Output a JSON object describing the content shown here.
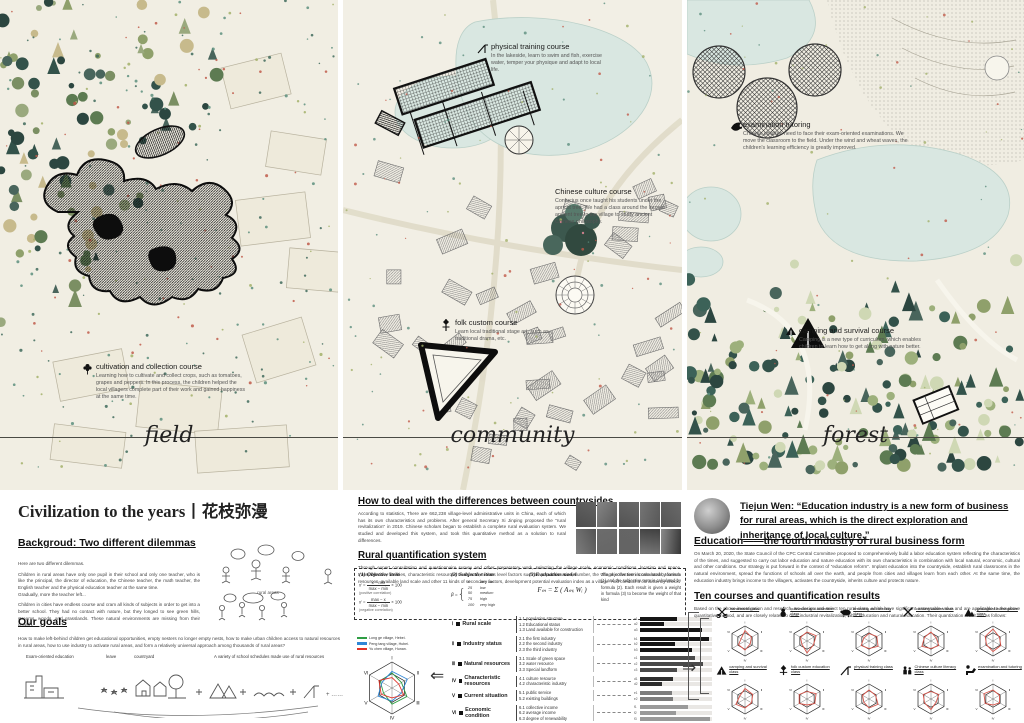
{
  "accent_colors": {
    "water": "#d9e7e1",
    "paper": "#f1eee3",
    "black": "#111111",
    "red_speckle": "#c05a4a"
  },
  "panels": {
    "field": {
      "label": "field",
      "annotation": {
        "icon": "flower-icon",
        "title": "cultivation and collection course",
        "body": "Learning how to cultivate and collect crops, such as tomatoes, grapes and peppers. In this process, the children helped the local villagers complete part of their work and gained happiness at the same time."
      }
    },
    "community": {
      "label": "community",
      "annotations": [
        {
          "icon": "slide-icon",
          "title": "physical training course",
          "body": "In the lakeside, learn to swim and fish, exercise water, temper your physique and adapt to local life."
        },
        {
          "icon": "tree-icon",
          "title": "Chinese culture course",
          "body": "Confucius once taught his students under the apricot tree. We had a class around the largest ancient tree in the village to study ancient Chinese philosophy."
        },
        {
          "icon": "totem-icon",
          "title": "folk custom course",
          "body": "Learn local traditional stage art, such as traditional drama, etc."
        }
      ]
    },
    "forest": {
      "label": "forest",
      "annotations": [
        {
          "icon": "bird-icon",
          "title": "examination tutoring",
          "body": "Chinese children need to face their exam-oriented examinations. We move the classroom to the field. Under the wind and wheat waves, the children's learning efficiency is greatly improved."
        },
        {
          "icon": "tent-icon",
          "title": "camping and survival course",
          "body": "Camping is a new type of curriculum, which enables children to learn how to get along with nature better."
        }
      ]
    }
  },
  "left": {
    "title": "Civilization to the years丨花枝弥漫",
    "background_heading": "Backgroud: Two different dilemmas",
    "p1": "Here are two different dilemmas.",
    "p2": "Children in rural areas have only one pupil in their school and only one teacher, who is like the principal, the director of education, the Chinese teacher, the math teacher, the English teacher and the physical education teacher at the same time.",
    "p3": "Gradually, more the teacher left...",
    "p4": "Children in cities have endless course and cram all kinds of subjects in order to get into a better school. They had no contact with nature, but they longed to see green hills, streams, woods, and grasslands. These natural environments are missing from their growth.",
    "sketch_caption_rural": "rural areas",
    "goals_heading": "Our goals",
    "goals_text": "How to make left-behind children get educational opportunities, empty nesters no longer empty nests, how to make urban children access to natural resources in rural areas, how to use industry to activate rural areas, and form a relatively universal approach among thousands of rural areas?",
    "goal_captions": [
      "Exam-oriented education",
      "leave",
      "countryard",
      "A variety of school schedules made use of rural resources"
    ],
    "goal_more": "……"
  },
  "middle": {
    "h1": "How to deal with the differences between countrysides",
    "p1": "According to statistics, There are 662,238 village-level administrative units in China, each of which has its own characteristics and problems. After general Secretary Xi Jinping proposed the \"rural revitalization\" in 2019. Chinese scholars began to establish a complete rural evaluation system. We studied and developed this system, and took this quantitative method as a solution to rural differences.",
    "h2": "Rural quantification system",
    "p2": "Through expert consultation and questionnaire survey and other preparatory work, selecting the village scale, economic conditions, location and space transportation, facilities, characteristic resources to expand, 6-class level factors such as population size, number, the village collective income scale, tourism resources, available land scale and other 11 kinds of secondary factors, development potential evaluation index as a village. And conduct a consistency check.",
    "formulas": {
      "obj_label": "(1) Objective item",
      "obj_f1_num": "x − min",
      "obj_f1_den": "max − min",
      "obj_f1_note": "(positive correlation)",
      "obj_f2_num": "max − x",
      "obj_f2_den": "max − min",
      "obj_f2_note": "(negative correlation)",
      "times100": "× 100",
      "subj_label": "(2) Subjective item",
      "subj_var": "β =",
      "subj_scale": [
        [
          "0",
          "very low"
        ],
        [
          "25",
          "low"
        ],
        [
          "50",
          "medium"
        ],
        [
          "75",
          "high"
        ],
        [
          "100",
          "very high"
        ]
      ],
      "model_label": "(3)Evaluation model",
      "model_formula": "Fₘ = Σ ( Aₘᵢ Wᵢ )",
      "note": "The objective term is calculated by formula (1) and the subjective term is calculated by formula (2). Each result is given a weight in formula (3) to become the weight of that kind"
    },
    "legend": [
      {
        "color": "#2f9e44",
        "label": "Long ge village, Hebei."
      },
      {
        "color": "#2f86d6",
        "label": "Peng tang village, Hubei."
      },
      {
        "color": "#e03127",
        "label": "Yu chen village, Hunan."
      }
    ],
    "categories": [
      {
        "numeral": "Ⅰ",
        "label": "Rural scale"
      },
      {
        "numeral": "Ⅱ",
        "label": "Industry status"
      },
      {
        "numeral": "Ⅲ",
        "label": "Natural resources"
      },
      {
        "numeral": "Ⅳ",
        "label": "Characteristic resources"
      },
      {
        "numeral": "Ⅴ",
        "label": "Current situation"
      },
      {
        "numeral": "Ⅵ",
        "label": "Economic condition"
      }
    ]
  },
  "right": {
    "quote": "Tiejun Wen: “Education industry is a new form of business for rural areas, which is the direct exploration and inheritance of local culture.”",
    "h1": "Education——the fourth industry of rural business form",
    "p1": "On March 20, 2020, the State Council of the CPC Central Committee proposed to comprehensively build a labor education system reflecting the characteristics of the times, and suggested to carry out labor education and nature education with its own characteristics in combination with local natural, economic, cultural and other conditions. Our strategy is put forward in the context of \"education reform\". Implant education into the countryside, establish rural classrooms in the natural environment, spread the functions of schools all over the earth, and people from cities and villages learn from each other. At the same time, the education industry brings income to the villagers, activates the countryside, inherits culture and protects nature.",
    "h2": "Ten courses and quantification results",
    "p2": "Based on the above investigation and research, we design and select ten rural class, which have significant assessable value and are applicable to the above quantitative method, and are closely related to rural industrial revitalization, labor education and natural education. Their quantization result are as follows:",
    "courses": [
      {
        "icon": "scissors-icon",
        "label": "handmade class",
        "radar": [
          0.7,
          0.5,
          0.4,
          0.6,
          0.5,
          0.3
        ]
      },
      {
        "icon": "gourd-icon",
        "label": "cultivation and collection class",
        "radar": [
          0.6,
          0.7,
          0.5,
          0.8,
          0.4,
          0.5
        ]
      },
      {
        "icon": "pig-icon",
        "label": "breeding and feeding class",
        "radar": [
          0.5,
          0.6,
          0.7,
          0.5,
          0.6,
          0.4
        ]
      },
      {
        "icon": "chopsticks-icon",
        "label": "cooking cuisine class",
        "radar": [
          0.6,
          0.4,
          0.6,
          0.5,
          0.7,
          0.5
        ]
      },
      {
        "icon": "mountain-icon",
        "label": "geological investigation class",
        "radar": [
          0.8,
          0.5,
          0.6,
          0.7,
          0.5,
          0.6
        ]
      },
      {
        "icon": "tent-icon",
        "label": "camping and survival class",
        "radar": [
          0.7,
          0.6,
          0.5,
          0.6,
          0.7,
          0.4
        ]
      },
      {
        "icon": "totem-icon",
        "label": "folk custom education class",
        "radar": [
          0.5,
          0.7,
          0.6,
          0.4,
          0.6,
          0.6
        ]
      },
      {
        "icon": "slide-icon",
        "label": "physical training class",
        "radar": [
          0.6,
          0.5,
          0.7,
          0.6,
          0.4,
          0.5
        ]
      },
      {
        "icon": "people-icon",
        "label": "Chinese culture literacy class",
        "radar": [
          0.5,
          0.6,
          0.4,
          0.7,
          0.5,
          0.6
        ]
      },
      {
        "icon": "desk-icon",
        "label": "examination and tutoring",
        "radar": [
          0.6,
          0.5,
          0.5,
          0.4,
          0.6,
          0.7
        ]
      }
    ]
  },
  "chart_data": [
    {
      "type": "radar",
      "title": "Village development potential comparison",
      "axes": [
        "Ⅰ",
        "Ⅱ",
        "Ⅲ",
        "Ⅳ",
        "Ⅴ",
        "Ⅵ"
      ],
      "range": [
        0,
        100
      ],
      "legend_position": "top-left",
      "series": [
        {
          "name": "Long ge village, Hebei.",
          "color": "#2f9e44",
          "values": [
            58,
            42,
            66,
            62,
            38,
            52
          ]
        },
        {
          "name": "Peng tang village, Hubei.",
          "color": "#2f86d6",
          "values": [
            64,
            68,
            40,
            50,
            62,
            44
          ]
        },
        {
          "name": "Yu chen village, Hunan.",
          "color": "#e03127",
          "values": [
            40,
            30,
            52,
            38,
            48,
            58
          ]
        }
      ]
    },
    {
      "type": "bar",
      "title": "Secondary factor quantification",
      "orientation": "horizontal",
      "xlim": [
        0,
        100
      ],
      "groups": [
        {
          "category": "Rural scale",
          "color": "#151515",
          "items": [
            {
              "code": "a1",
              "label": "1.1 population structure",
              "value": 52
            },
            {
              "code": "a2",
              "label": "1.2 Educational status",
              "value": 34
            },
            {
              "code": "a3",
              "label": "1.3 Land available for construction",
              "value": 86
            }
          ]
        },
        {
          "category": "Industry status",
          "color": "#151515",
          "items": [
            {
              "code": "b1",
              "label": "2.1 the first industry",
              "value": 96
            },
            {
              "code": "b2",
              "label": "2.2 the second industry",
              "value": 48
            },
            {
              "code": "b3",
              "label": "2.3 the third industry",
              "value": 72
            }
          ]
        },
        {
          "category": "Natural resources",
          "color": "#4a4a4a",
          "items": [
            {
              "code": "c1",
              "label": "3.1 Scale of green space",
              "value": 76
            },
            {
              "code": "c2",
              "label": "3.2 water resource",
              "value": 88
            },
            {
              "code": "c3",
              "label": "3.3 Special landform",
              "value": 52
            }
          ]
        },
        {
          "category": "Characteristic resources",
          "color": "#2e2e2e",
          "items": [
            {
              "code": "d1",
              "label": "4.1 culture resource",
              "value": 46
            },
            {
              "code": "d2",
              "label": "4.2 characteristic industry",
              "value": 30
            }
          ]
        },
        {
          "category": "Current situation",
          "color": "#7d7d7d",
          "items": [
            {
              "code": "e1",
              "label": "5.1 public service",
              "value": 44
            },
            {
              "code": "e2",
              "label": "5.2 existing buildings",
              "value": 46
            }
          ]
        },
        {
          "category": "Economic condition",
          "color": "#9a9a9a",
          "items": [
            {
              "code": "f1",
              "label": "6.1 collective income",
              "value": 66
            },
            {
              "code": "f2",
              "label": "6.2 average income",
              "value": 50
            },
            {
              "code": "f3",
              "label": "6.3 degree of renewability",
              "value": 97
            }
          ]
        }
      ]
    }
  ]
}
